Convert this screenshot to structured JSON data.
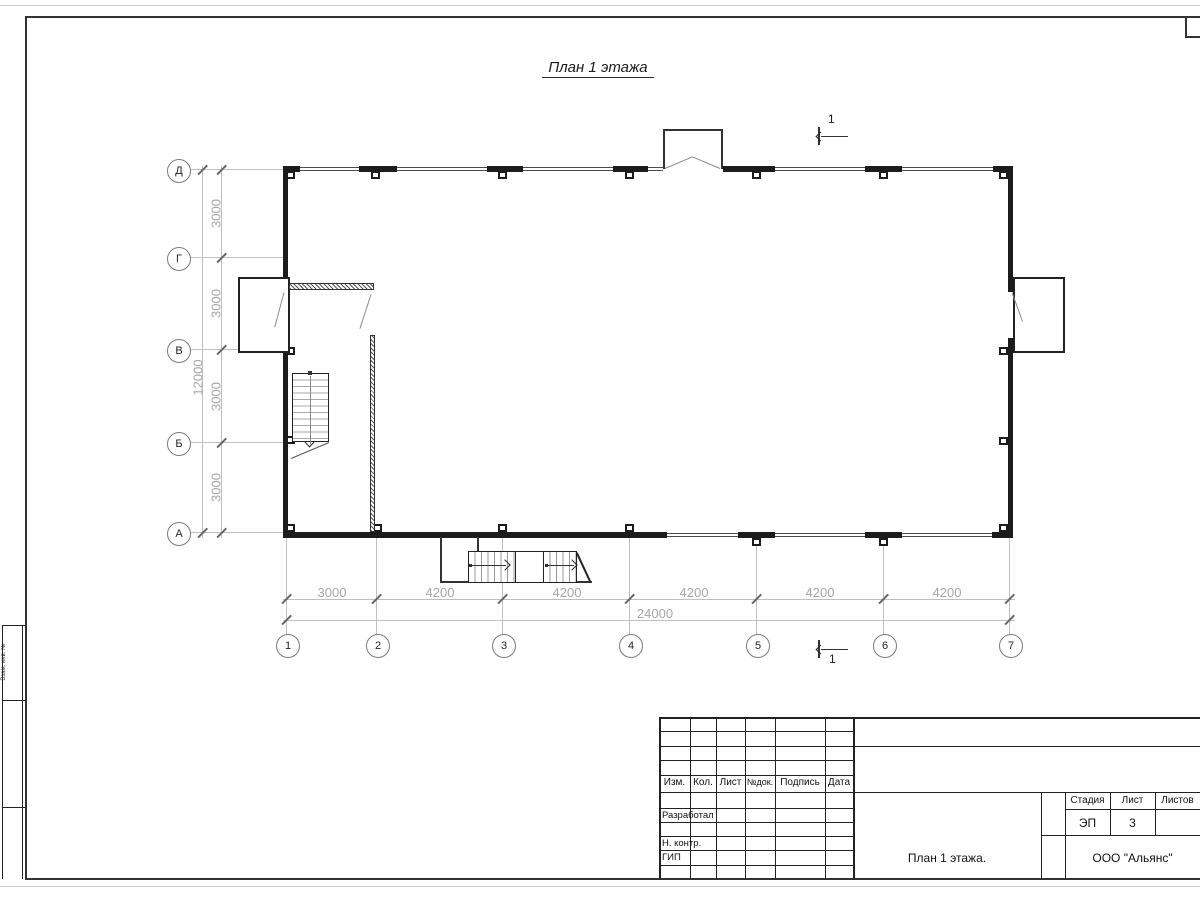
{
  "sheet": {
    "drawing_title": "План 1 этажа",
    "section_mark_label": "1"
  },
  "axes": {
    "vertical": [
      "Д",
      "Г",
      "В",
      "Б",
      "А"
    ],
    "horizontal": [
      "1",
      "2",
      "3",
      "4",
      "5",
      "6",
      "7"
    ]
  },
  "dimensions": {
    "left_segments": [
      "3000",
      "3000",
      "3000",
      "3000"
    ],
    "left_total": "12000",
    "bottom_segments": [
      "3000",
      "4200",
      "4200",
      "4200",
      "4200",
      "4200"
    ],
    "bottom_total": "24000"
  },
  "title_block": {
    "columns": [
      "Изм.",
      "Кол.",
      "Лист",
      "№док.",
      "Подпись",
      "Дата"
    ],
    "rows": [
      "Разработал",
      "Н. контр.",
      "ГИП"
    ],
    "stage_label": "Стадия",
    "sheet_label": "Лист",
    "sheets_label": "Листов",
    "stage_value": "ЭП",
    "sheet_value": "3",
    "doc_title": "План 1 этажа.",
    "company": "ООО \"Альянс\""
  },
  "margin_stamp": {
    "label": "Взам. инв. №"
  }
}
